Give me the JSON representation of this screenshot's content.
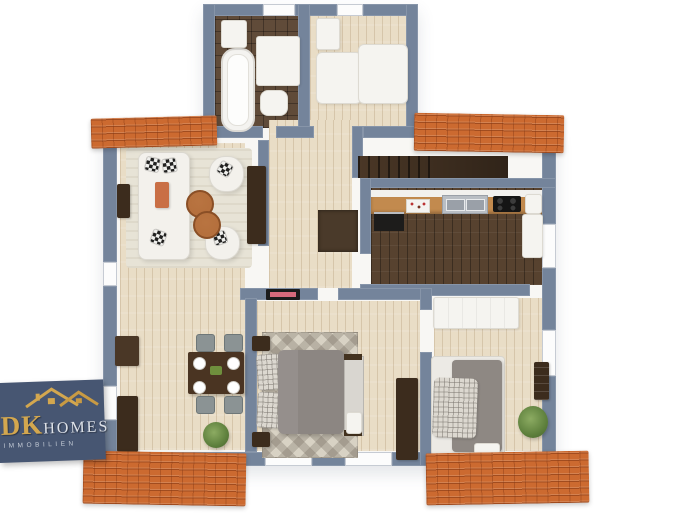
{
  "meta": {
    "description": "3D top-down rendered floor plan of a furnished single-storey flat with terracotta roof sections"
  },
  "logo": {
    "brand_primary": "DK",
    "brand_secondary": "HOMES",
    "tagline": "IMMOBILIEN"
  },
  "colors": {
    "background": "#ffffff",
    "wall": "#74849b",
    "interior": "#f7f6f3",
    "roof": "#cc6a30",
    "roof_line": "#8a3c16",
    "floor_light": "#e9ddc6",
    "floor_dark": "#57422f",
    "bath_tile": "#604b39",
    "rug_living": "#e7e3d6",
    "rug_bedroom": "#d8d2c4",
    "sofa_white": "#f3f1ec",
    "throw_orange": "#c96f45",
    "wood_furniture": "#3c2c1d",
    "duvet_gray": "#8c8682",
    "chair_gray": "#8b9394",
    "plant_green": "#5d7f3c",
    "logo_bg": "#475672",
    "logo_gold": "#d3a74f",
    "logo_silver": "#dde1e8"
  },
  "floorplan": {
    "roof_segments": 4,
    "rooms": [
      {
        "name": "bathroom",
        "floor": "dark-tile",
        "furniture": [
          "bathtub",
          "washbasin",
          "vanity",
          "toilet"
        ]
      },
      {
        "name": "entry-room",
        "floor": "light-wood",
        "furniture": [
          "wardrobe",
          "cabinet"
        ]
      },
      {
        "name": "living-room",
        "floor": "light-wood-with-rug",
        "furniture": [
          "sofa",
          "armchair",
          "armchair",
          "coffee-table",
          "coffee-table",
          "tv-sideboard",
          "wall-shelf"
        ]
      },
      {
        "name": "dining-area",
        "floor": "light-wood",
        "furniture": [
          "dining-table",
          "four-chairs",
          "four-plates",
          "sideboard",
          "plant"
        ]
      },
      {
        "name": "hallway",
        "floor": "light-wood",
        "furniture": [
          "staircase",
          "floor-opening"
        ]
      },
      {
        "name": "kitchen",
        "floor": "dark-parquet",
        "furniture": [
          "counter",
          "sink",
          "cooktop",
          "oven",
          "outlet-panel",
          "coffee-machine",
          "tall-cabinet"
        ]
      },
      {
        "name": "bedroom",
        "floor": "light-wood",
        "furniture": [
          "double-bed",
          "nightstands",
          "bench",
          "wardrobe",
          "patterned-rug",
          "wall-picture"
        ]
      },
      {
        "name": "small-bedroom",
        "floor": "light-wood",
        "furniture": [
          "single-bed",
          "plaid-pillow",
          "wardrobe",
          "plant",
          "wall-shelf",
          "breakfast-tray"
        ]
      }
    ]
  }
}
